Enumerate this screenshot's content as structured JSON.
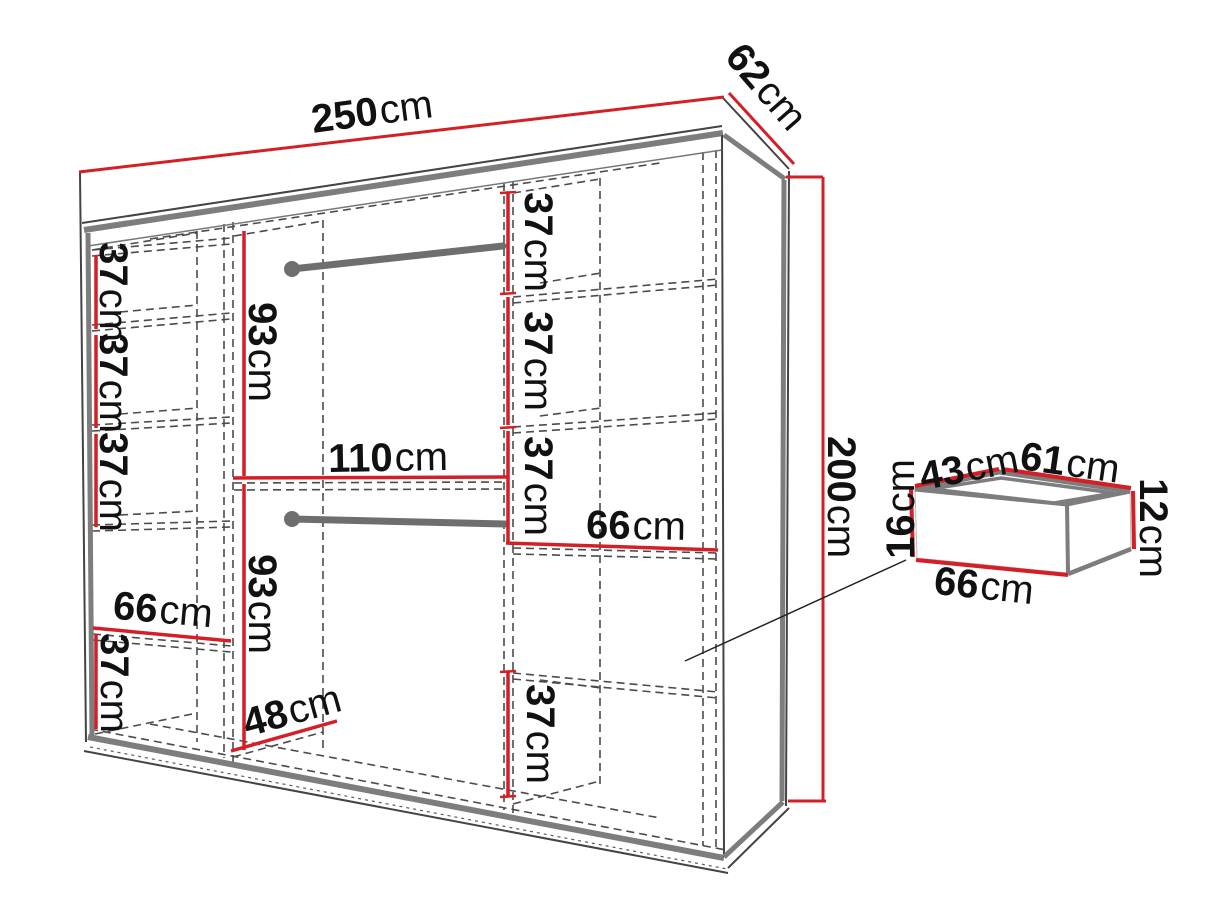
{
  "page": {
    "background": "#ffffff"
  },
  "diagram": {
    "title": "Sliding wardrobe dimension diagram with under-bed drawer box",
    "units": "cm",
    "colors": {
      "dimension_line": "#d41f26",
      "frame_gray": "#7d7d7d",
      "hidden_dash": "#4b4b4b",
      "text": "#111111"
    },
    "overall": {
      "width_cm": 250,
      "depth_cm": 62,
      "height_cm": 200
    },
    "left_column_shelf_gaps_cm": [
      37,
      37,
      37,
      37
    ],
    "left_column_shelf_width_cm": 66,
    "middle_column_hanging_sections_cm": [
      93,
      93
    ],
    "middle_column_width_cm": 110,
    "middle_column_floor_depth_cm": 48,
    "right_column_shelf_gaps_cm": [
      37,
      37,
      37,
      37
    ],
    "right_column_shelf_width_cm": 66,
    "drawer_box": {
      "top_width_cm": 43,
      "top_depth_cm": 61,
      "front_height_cm": 16,
      "back_height_cm": 12,
      "front_width_cm": 66
    }
  },
  "labels": {
    "width": {
      "value": "250",
      "unit": "cm"
    },
    "depth": {
      "value": "62",
      "unit": "cm"
    },
    "height": {
      "value": "200",
      "unit": "cm"
    },
    "left_gap_1": {
      "value": "37",
      "unit": "cm"
    },
    "left_gap_2": {
      "value": "37",
      "unit": "cm"
    },
    "left_gap_3": {
      "value": "37",
      "unit": "cm"
    },
    "left_shelf_width": {
      "value": "66",
      "unit": "cm"
    },
    "left_gap_4": {
      "value": "37",
      "unit": "cm"
    },
    "mid_hang_upper": {
      "value": "93",
      "unit": "cm"
    },
    "mid_width": {
      "value": "110",
      "unit": "cm"
    },
    "mid_hang_lower": {
      "value": "93",
      "unit": "cm"
    },
    "mid_floor_depth": {
      "value": "48",
      "unit": "cm"
    },
    "right_gap_1": {
      "value": "37",
      "unit": "cm"
    },
    "right_gap_2": {
      "value": "37",
      "unit": "cm"
    },
    "right_gap_3": {
      "value": "37",
      "unit": "cm"
    },
    "right_shelf_width": {
      "value": "66",
      "unit": "cm"
    },
    "right_gap_4": {
      "value": "37",
      "unit": "cm"
    },
    "drawer_top_width": {
      "value": "43",
      "unit": "cm"
    },
    "drawer_top_depth": {
      "value": "61",
      "unit": "cm"
    },
    "drawer_front_height": {
      "value": "16",
      "unit": "cm"
    },
    "drawer_back_height": {
      "value": "12",
      "unit": "cm"
    },
    "drawer_front_width": {
      "value": "66",
      "unit": "cm"
    }
  }
}
